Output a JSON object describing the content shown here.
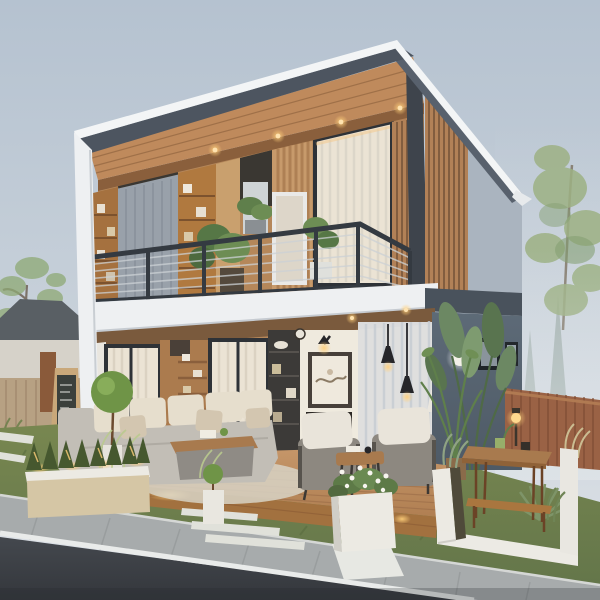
{
  "scene": {
    "type": "architectural-render",
    "description": "Modern two-storey house at dusk with open front facade, wood-panelled upper floor with shelving and balcony, furnished ground-floor living room, wooden deck, landscaped front yard with planters, garden table, neighbouring house, and asphalt street in the foreground",
    "objects": [
      "skillion-roof",
      "recessed-ceiling-lights",
      "upper-shelving",
      "gray-curtain",
      "balcony-railing",
      "balcony-plants",
      "white-balcony-fascia",
      "living-room-sofa",
      "coffee-table",
      "wall-art",
      "wall-sconce",
      "fireplace",
      "pendant-lights",
      "floor-lamp",
      "armchairs",
      "side-table",
      "sheer-curtains",
      "topiary-ball",
      "wood-slat-column",
      "gray-wing-wall",
      "ball-wall-light",
      "picture-frames",
      "tropical-plants",
      "timber-fence",
      "garden-table",
      "table-lamp",
      "wooden-deck",
      "led-strip-lights",
      "hedge-planter",
      "flower-planter",
      "white-garden-curbs",
      "ornamental-grasses",
      "stepping-stones",
      "walkway",
      "neighbour-house",
      "chalkboard-sign",
      "street-tree",
      "background-trees",
      "sidewalk",
      "road",
      "road-edge-line"
    ]
  },
  "palette": {
    "sky_top": "#b5c2d0",
    "sky_mid": "#c8d1da",
    "sky_bottom": "#dfe3e8",
    "roof_white": "#f3f5f6",
    "fascia_front": "#4d5560",
    "fascia_side": "#58616d",
    "ceiling_wood": "#bf8a5c",
    "ceiling_line": "#8a5f3c",
    "wood_wall": "#b5875a",
    "wood_dark": "#8a6040",
    "wood_light": "#c99c6d",
    "white_trim": "#eef0f2",
    "curtain_gray": "#99a1aa",
    "curtain_cream": "#ebe3d4",
    "sheer": "#e3e6e9",
    "dark_frame": "#2e3237",
    "dark_block": "#3a3732",
    "railing": "#343a41",
    "railing_slat": "#ccd1d5",
    "slat_wood": "#b28157",
    "slat_gap": "#6e4e35",
    "gable_gray": "#aab4bf",
    "wing_wall": "#5d6a77",
    "wing_band": "#49525c",
    "interior_white": "#efeade",
    "art_frame": "#47403a",
    "sofa": "#c2beb6",
    "cushion": "#e6decd",
    "pillow": "#d3c6b0",
    "table_wood": "#a87a4e",
    "chair_base": "#8d8880",
    "chair_cushion": "#e9e4da",
    "pendant": "#26262a",
    "warm_light": "#ffcf7a",
    "lamp_shade": "#eae6de",
    "deck_light": "#c59669",
    "deck_dark": "#b07f52",
    "deck_skirt": "#a2713f",
    "planter_white": "#eceae3",
    "planter_tan": "#d5c6a5",
    "shrub": "#46582f",
    "topiary": "#6f9447",
    "grass_light": "#788750",
    "grass_dark": "#64764a",
    "stone": "#e0e1da",
    "sidewalk": "#a7abac",
    "curb": "#d5d7d5",
    "road_top": "#44484e",
    "road_bottom": "#34373c",
    "road_line": "#e9ebea",
    "fence": "#9a6245",
    "fence_line": "#7c4c33",
    "fence_rail": "#b07a52",
    "neighbour_roof": "#595f64",
    "neighbour_wall": "#d6d2c9",
    "neighbour_fence": "#b7a183",
    "gate": "#8a5a3a",
    "chalkboard": "#3b403c",
    "board_frame": "#c9a87a",
    "tree_left": "#8ea974",
    "tree_right": "#9db184",
    "conifer": "#7d9184",
    "mist": "#dfe4e8",
    "soil": "#4f4a3a",
    "sage": "#8fa383",
    "wheat": "#cbbd92",
    "agave": "#7e9468",
    "leaf": "#6c8863",
    "leaf_dark": "#59744f"
  }
}
